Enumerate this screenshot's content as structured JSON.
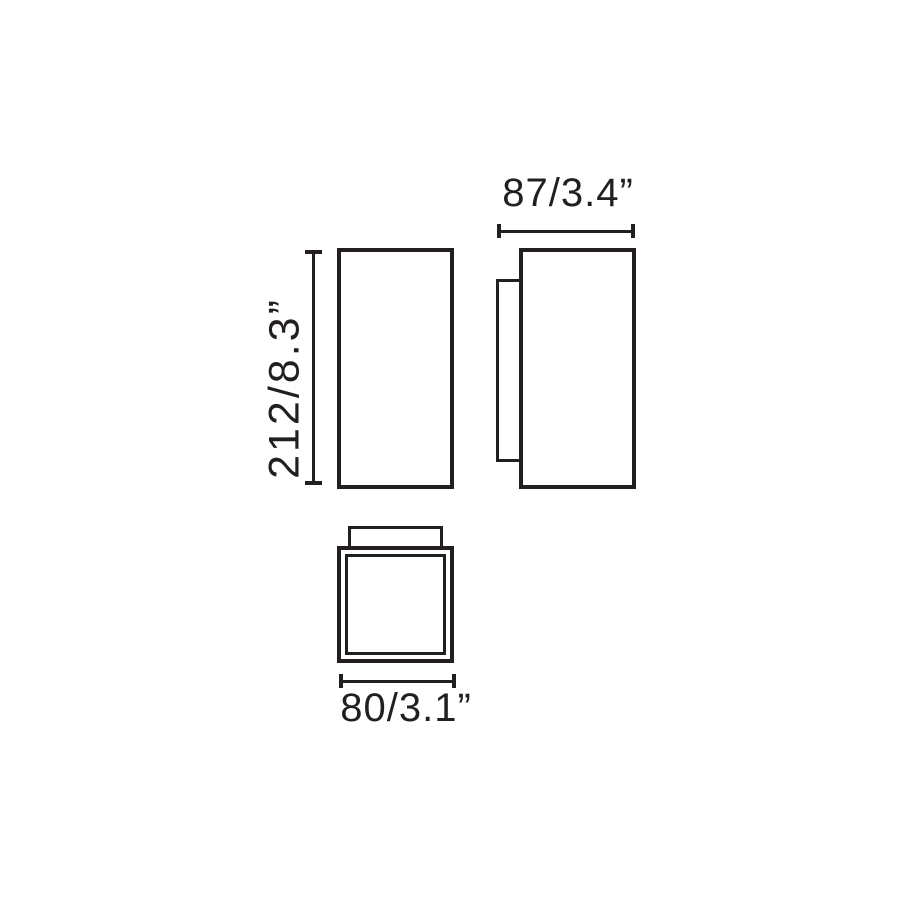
{
  "page": {
    "background": "#ffffff",
    "ink_color": "#231f20"
  },
  "diagram": {
    "dimensions": {
      "height": {
        "label": "212/8.3”",
        "millimeters": 212,
        "inches": 8.3
      },
      "depth": {
        "label": "87/3.4”",
        "millimeters": 87,
        "inches": 3.4
      },
      "width": {
        "label": "80/3.1”",
        "millimeters": 80,
        "inches": 3.1
      }
    }
  }
}
